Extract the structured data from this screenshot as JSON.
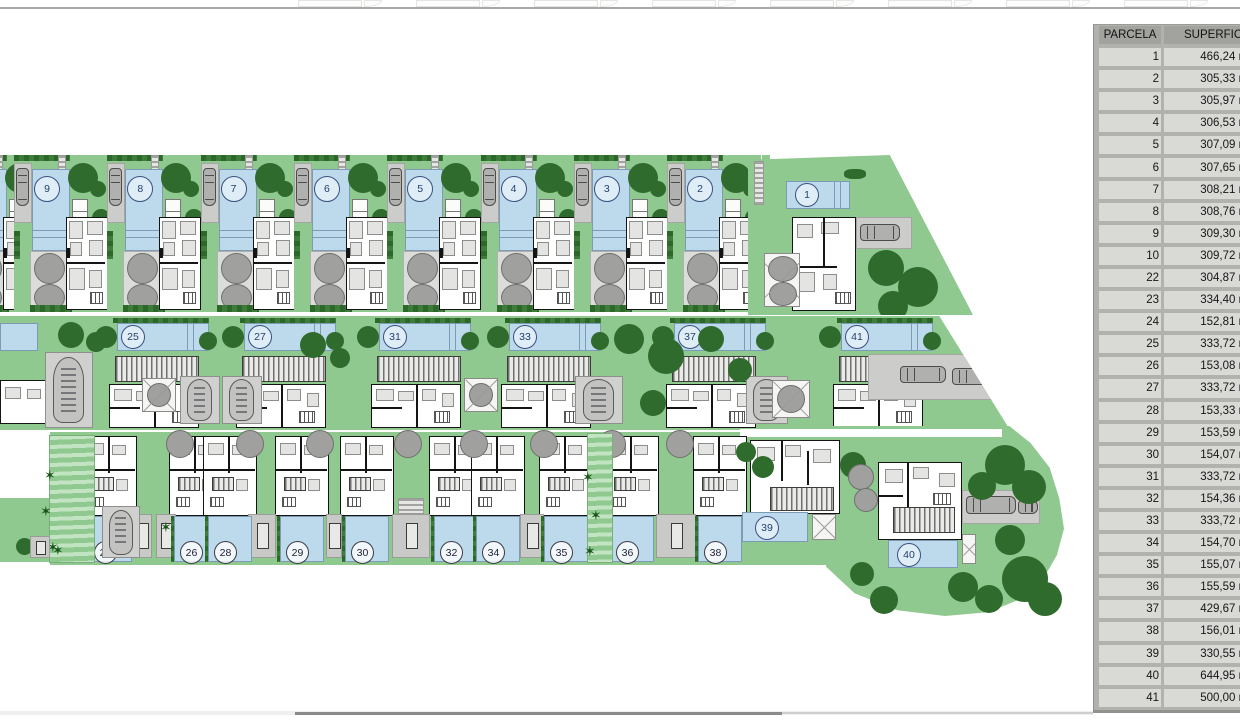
{
  "plan": {
    "top_row": [
      "9",
      "8",
      "7",
      "6",
      "5",
      "4",
      "3",
      "2"
    ],
    "corner": "1",
    "middle_row": [
      "25",
      "27",
      "31",
      "33",
      "37",
      "41"
    ],
    "bottom_pools": [
      "24",
      "26",
      "28",
      "29",
      "30",
      "32",
      "34",
      "35",
      "36",
      "38"
    ],
    "lower_right": [
      "39",
      "40"
    ],
    "colors": {
      "garden": "#8fc98f",
      "pool": "#bdd9ec",
      "tree": "#2e6b2c",
      "canopy": "#a0a09e",
      "drive": "#cccccb",
      "wall": "#141414",
      "table_bg": "#b1b1ae",
      "table_row": "#d9d9d6",
      "table_header": "#a2a29f"
    }
  },
  "table": {
    "headers": {
      "parcela": "PARCELA",
      "superficie": "SUPERFICIE"
    },
    "rows": [
      {
        "parcela": "1",
        "superficie": "466,24 m²"
      },
      {
        "parcela": "2",
        "superficie": "305,33 m²"
      },
      {
        "parcela": "3",
        "superficie": "305,97 m²"
      },
      {
        "parcela": "4",
        "superficie": "306,53 m²"
      },
      {
        "parcela": "5",
        "superficie": "307,09 m²"
      },
      {
        "parcela": "6",
        "superficie": "307,65 m²"
      },
      {
        "parcela": "7",
        "superficie": "308,21 m²"
      },
      {
        "parcela": "8",
        "superficie": "308,76 m²"
      },
      {
        "parcela": "9",
        "superficie": "309,30 m²"
      },
      {
        "parcela": "10",
        "superficie": "309,72 m²"
      },
      {
        "parcela": "22",
        "superficie": "304,87 m²"
      },
      {
        "parcela": "23",
        "superficie": "334,40 m²"
      },
      {
        "parcela": "24",
        "superficie": "152,81 m²"
      },
      {
        "parcela": "25",
        "superficie": "333,72 m²"
      },
      {
        "parcela": "26",
        "superficie": "153,08 m²"
      },
      {
        "parcela": "27",
        "superficie": "333,72 m²"
      },
      {
        "parcela": "28",
        "superficie": "153,33 m²"
      },
      {
        "parcela": "29",
        "superficie": "153,59 m²"
      },
      {
        "parcela": "30",
        "superficie": "154,07 m²"
      },
      {
        "parcela": "31",
        "superficie": "333,72 m²"
      },
      {
        "parcela": "32",
        "superficie": "154,36 m²"
      },
      {
        "parcela": "33",
        "superficie": "333,72 m²"
      },
      {
        "parcela": "34",
        "superficie": "154,70 m²"
      },
      {
        "parcela": "35",
        "superficie": "155,07 m²"
      },
      {
        "parcela": "36",
        "superficie": "155,59 m²"
      },
      {
        "parcela": "37",
        "superficie": "429,67 m²"
      },
      {
        "parcela": "38",
        "superficie": "156,01 m²"
      },
      {
        "parcela": "39",
        "superficie": "330,55 m²"
      },
      {
        "parcela": "40",
        "superficie": "644,95 m²"
      },
      {
        "parcela": "41",
        "superficie": "500,00 m²"
      }
    ]
  }
}
